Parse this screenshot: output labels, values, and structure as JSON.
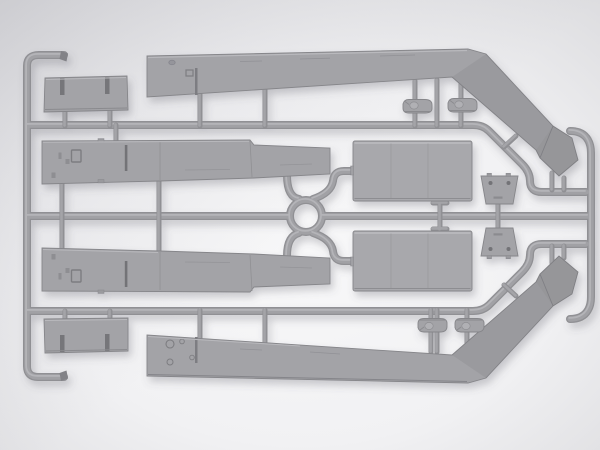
{
  "meta": {
    "subject": "Gray injection-molded plastic model kit sprue with armored-vehicle parts, photographed on a light gray studio background",
    "orientation": "horizontal sprue, parts mirrored about the horizontal centerline",
    "visible_text": "none"
  },
  "colors": {
    "background_center": "#f8f8f9",
    "background_edge": "#dbdbde",
    "corner_shade": "#8c8c96",
    "plastic_face": "#a3a3a7",
    "plastic_face_light": "#a8a8ac",
    "runner_core": "#909094",
    "runner_mid": "#a1a1a5",
    "runner_highlight": "#b7b7bb",
    "detail_dark": "#737377",
    "detail_line": "#8b8b8f",
    "edge_highlight": "#bcbcc0",
    "cast_shadow": "#5a5a66"
  },
  "sprue": {
    "frame": [
      {
        "name": "left-rail",
        "desc": "vertical runner with short hooked ends top and bottom"
      },
      {
        "name": "upper-rail",
        "desc": "horizontal runner bending diagonally down at right"
      },
      {
        "name": "center-rail",
        "desc": "horizontal runner through center, interrupted by molding ring"
      },
      {
        "name": "lower-rail",
        "desc": "horizontal runner bending diagonally up at right"
      },
      {
        "name": "right-rail",
        "desc": "vertical runner with curled rounded tips"
      },
      {
        "name": "center-ring",
        "desc": "circular runner ring at sprue center"
      }
    ],
    "parts": [
      {
        "name": "roof-panel-top",
        "desc": "small rectangular panel with two slots",
        "approx_box": [
          44,
          76,
          128,
          112
        ]
      },
      {
        "name": "hull-side-upper",
        "desc": "long tapered hull side with hatch and latch details",
        "approx_box": [
          42,
          140,
          330,
          184
        ]
      },
      {
        "name": "fender-upper",
        "desc": "long tapered fender bending into diagonal arm with arrow-shaped mud flap",
        "approx_box": [
          147,
          49,
          580,
          177
        ]
      },
      {
        "name": "hatch-small-top-left",
        "desc": "small rounded hatch with center boss",
        "approx_box": [
          403,
          99,
          433,
          113
        ]
      },
      {
        "name": "hatch-small-top-right",
        "desc": "small rounded hatch with center boss",
        "approx_box": [
          448,
          98,
          478,
          113
        ]
      },
      {
        "name": "deck-panel-upper",
        "desc": "large rectangular deck panel",
        "approx_box": [
          353,
          141,
          472,
          201
        ]
      },
      {
        "name": "bracket-upper",
        "desc": "small trapezoid bracket with two holes",
        "approx_box": [
          481,
          173,
          518,
          204
        ]
      },
      {
        "name": "bracket-lower",
        "desc": "small trapezoid bracket with two holes, mirrored",
        "approx_box": [
          481,
          228,
          518,
          259
        ]
      },
      {
        "name": "deck-panel-lower",
        "desc": "large rectangular deck panel, mirrored",
        "approx_box": [
          353,
          231,
          472,
          291
        ]
      },
      {
        "name": "hatch-small-bottom-left",
        "desc": "small rounded hatch with center boss, mirrored",
        "approx_box": [
          418,
          316,
          448,
          332
        ]
      },
      {
        "name": "hatch-small-bottom-right",
        "desc": "small rounded hatch with center boss, mirrored",
        "approx_box": [
          455,
          316,
          483,
          332
        ]
      },
      {
        "name": "hull-side-lower",
        "desc": "long tapered hull side, mirrored",
        "approx_box": [
          42,
          248,
          330,
          292
        ]
      },
      {
        "name": "fender-lower",
        "desc": "long tapered fender with arrow-shaped mud flap, mirrored",
        "approx_box": [
          147,
          255,
          580,
          383
        ]
      },
      {
        "name": "roof-panel-bottom",
        "desc": "small rectangular panel with two slots, mirrored",
        "approx_box": [
          44,
          318,
          128,
          353
        ]
      }
    ]
  }
}
